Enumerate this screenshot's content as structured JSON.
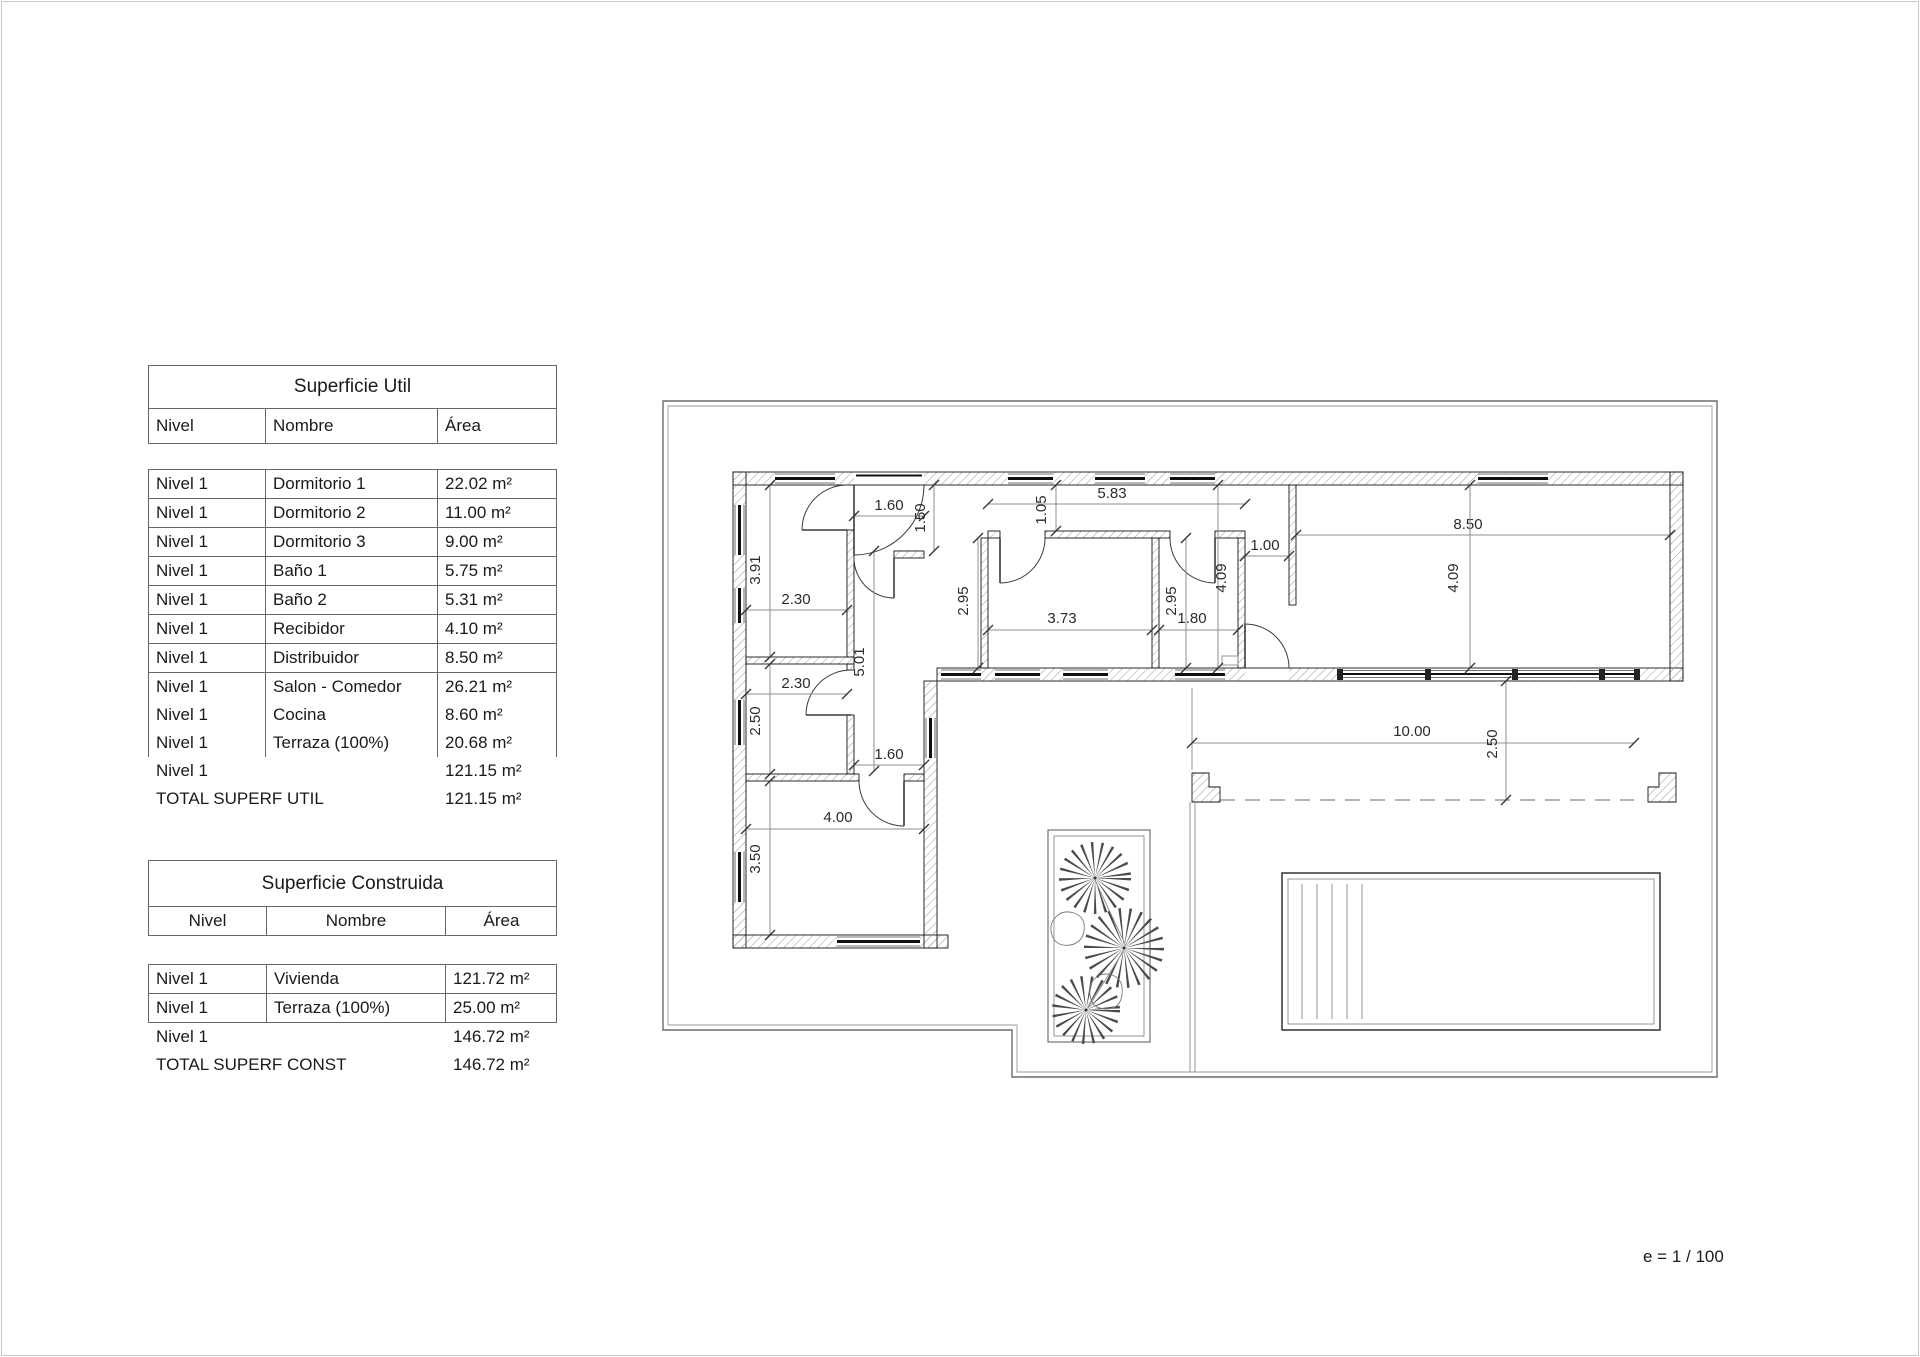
{
  "page": {
    "scale_note": "e = 1 / 100"
  },
  "tables": {
    "util": {
      "title": "Superficie Util",
      "headers": [
        "Nivel",
        "Nombre",
        "Área"
      ],
      "rows": [
        [
          "Nivel 1",
          "Dormitorio 1",
          "22.02 m²"
        ],
        [
          "Nivel 1",
          "Dormitorio 2",
          "11.00 m²"
        ],
        [
          "Nivel 1",
          "Dormitorio 3",
          "9.00 m²"
        ],
        [
          "Nivel 1",
          "Baño 1",
          "5.75 m²"
        ],
        [
          "Nivel 1",
          "Baño 2",
          "5.31 m²"
        ],
        [
          "Nivel 1",
          "Recibidor",
          "4.10 m²"
        ],
        [
          "Nivel 1",
          "Distribuidor",
          "8.50 m²"
        ],
        [
          "Nivel 1",
          "Salon - Comedor",
          "26.21 m²"
        ],
        [
          "Nivel 1",
          "Cocina",
          "8.60 m²"
        ],
        [
          "Nivel 1",
          "Terraza (100%)",
          "20.68 m²"
        ]
      ],
      "subtotal": {
        "label": "Nivel 1",
        "value": "121.15 m²"
      },
      "total": {
        "label": "TOTAL SUPERF UTIL",
        "value": "121.15 m²"
      }
    },
    "construida": {
      "title": "Superficie Construida",
      "headers": [
        "Nivel",
        "Nombre",
        "Área"
      ],
      "rows": [
        [
          "Nivel 1",
          "Vivienda",
          "121.72 m²"
        ],
        [
          "Nivel 1",
          "Terraza (100%)",
          "25.00 m²"
        ]
      ],
      "subtotal": {
        "label": "Nivel 1",
        "value": "146.72 m²"
      },
      "total": {
        "label": "TOTAL SUPERF CONST",
        "value": "146.72 m²"
      }
    }
  },
  "plan": {
    "dimensions": [
      {
        "t": "1.60",
        "x": 889,
        "y": 510,
        "r": 0,
        "l": [
          854,
          516,
          924,
          516
        ]
      },
      {
        "t": "1.50",
        "x": 925,
        "y": 518,
        "r": -90,
        "l": [
          934,
          485,
          934,
          551
        ]
      },
      {
        "t": "5.83",
        "x": 1112,
        "y": 498,
        "r": 0,
        "l": [
          988,
          504,
          1245,
          504
        ]
      },
      {
        "t": "1.05",
        "x": 1046,
        "y": 510,
        "r": -90,
        "l": [
          1056,
          485,
          1056,
          531
        ]
      },
      {
        "t": "1.00",
        "x": 1265,
        "y": 550,
        "r": 0,
        "l": [
          1245,
          556,
          1289,
          556
        ]
      },
      {
        "t": "8.50",
        "x": 1468,
        "y": 529,
        "r": 0,
        "l": [
          1296,
          535,
          1670,
          535
        ]
      },
      {
        "t": "4.09",
        "x": 1226,
        "y": 578,
        "r": -90,
        "l": [
          1218,
          485,
          1218,
          668
        ]
      },
      {
        "t": "4.09",
        "x": 1458,
        "y": 578,
        "r": -90,
        "l": [
          1470,
          485,
          1470,
          668
        ]
      },
      {
        "t": "2.95",
        "x": 968,
        "y": 601,
        "r": -90,
        "l": [
          978,
          538,
          978,
          668
        ]
      },
      {
        "t": "3.73",
        "x": 1062,
        "y": 623,
        "r": 0,
        "l": [
          988,
          630,
          1152,
          630
        ]
      },
      {
        "t": "1.80",
        "x": 1192,
        "y": 623,
        "r": 0,
        "l": [
          1159,
          630,
          1238,
          630
        ]
      },
      {
        "t": "2.95",
        "x": 1176,
        "y": 601,
        "r": -90,
        "l": [
          1186,
          538,
          1186,
          668
        ]
      },
      {
        "t": "3.91",
        "x": 760,
        "y": 570,
        "r": -90,
        "l": [
          770,
          485,
          770,
          657
        ]
      },
      {
        "t": "2.30",
        "x": 796,
        "y": 604,
        "r": 0,
        "l": [
          746,
          610,
          847,
          610
        ]
      },
      {
        "t": "2.30",
        "x": 796,
        "y": 688,
        "r": 0,
        "l": [
          746,
          694,
          847,
          694
        ]
      },
      {
        "t": "2.50",
        "x": 760,
        "y": 721,
        "r": -90,
        "l": [
          770,
          664,
          770,
          774
        ]
      },
      {
        "t": "5.01",
        "x": 864,
        "y": 662,
        "r": -90,
        "l": [
          874,
          551,
          874,
          771
        ]
      },
      {
        "t": "1.60",
        "x": 889,
        "y": 759,
        "r": 0,
        "l": [
          854,
          765,
          924,
          765
        ]
      },
      {
        "t": "4.00",
        "x": 838,
        "y": 822,
        "r": 0,
        "l": [
          746,
          829,
          924,
          829
        ]
      },
      {
        "t": "3.50",
        "x": 760,
        "y": 859,
        "r": -90,
        "l": [
          770,
          781,
          770,
          935
        ]
      },
      {
        "t": "10.00",
        "x": 1412,
        "y": 736,
        "r": 0,
        "l": [
          1192,
          743,
          1634,
          743
        ]
      },
      {
        "t": "2.50",
        "x": 1497,
        "y": 744,
        "r": -90,
        "l": [
          1506,
          681,
          1506,
          800
        ]
      }
    ]
  }
}
